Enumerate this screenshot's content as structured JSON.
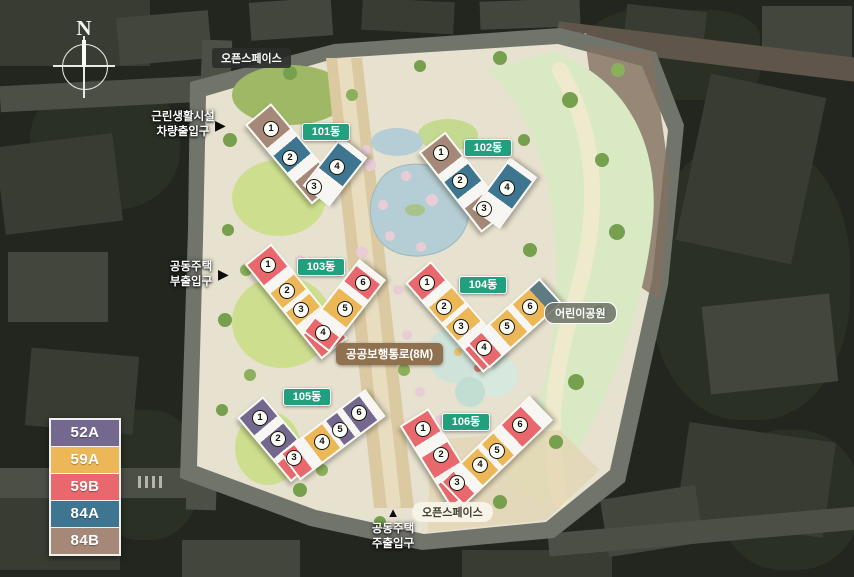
{
  "compass": {
    "label": "N"
  },
  "legend": [
    {
      "code": "52A",
      "color": "#75688f"
    },
    {
      "code": "59A",
      "color": "#ecb857"
    },
    {
      "code": "59B",
      "color": "#e8686d"
    },
    {
      "code": "84A",
      "color": "#3e7591"
    },
    {
      "code": "84B",
      "color": "#a58877"
    }
  ],
  "site_labels": {
    "open_space_top": "오픈스페이스",
    "open_space_bottom": "오픈스페이스",
    "children_park": "어린이공원",
    "public_walkway": "공공보행통로(8M)"
  },
  "entrances": [
    {
      "name": "근린생활시설 차량출입구",
      "line1": "근린생활시설",
      "line2": "차량출입구",
      "arrow": "▶"
    },
    {
      "name": "공동주택 부출입구",
      "line1": "공동주택",
      "line2": "부출입구",
      "arrow": "▶"
    },
    {
      "name": "공동주택 주출입구",
      "line1": "공동주택",
      "line2": "주출입구",
      "arrow": "▲"
    }
  ],
  "buildings": [
    {
      "name": "101동",
      "units": [
        {
          "no": "1",
          "type": "84B"
        },
        {
          "no": "2",
          "type": "84A"
        },
        {
          "no": "3",
          "type": "84B"
        },
        {
          "no": "4",
          "type": "84A"
        }
      ]
    },
    {
      "name": "102동",
      "units": [
        {
          "no": "1",
          "type": "84B"
        },
        {
          "no": "2",
          "type": "84A"
        },
        {
          "no": "3",
          "type": "84B"
        },
        {
          "no": "4",
          "type": "84A"
        }
      ]
    },
    {
      "name": "103동",
      "units": [
        {
          "no": "1",
          "type": "59B"
        },
        {
          "no": "2",
          "type": "59A"
        },
        {
          "no": "3",
          "type": "59A"
        },
        {
          "no": "4",
          "type": "59B"
        },
        {
          "no": "5",
          "type": "59A"
        },
        {
          "no": "6",
          "type": "59B"
        }
      ]
    },
    {
      "name": "104동",
      "units": [
        {
          "no": "1",
          "type": "59B"
        },
        {
          "no": "2",
          "type": "59A"
        },
        {
          "no": "3",
          "type": "59A"
        },
        {
          "no": "4",
          "type": "59B"
        },
        {
          "no": "5",
          "type": "59A"
        },
        {
          "no": "6",
          "type": "59A"
        }
      ]
    },
    {
      "name": "105동",
      "units": [
        {
          "no": "1",
          "type": "52A"
        },
        {
          "no": "2",
          "type": "52A"
        },
        {
          "no": "3",
          "type": "59B"
        },
        {
          "no": "4",
          "type": "59A"
        },
        {
          "no": "5",
          "type": "52A"
        },
        {
          "no": "6",
          "type": "52A"
        }
      ]
    },
    {
      "name": "106동",
      "units": [
        {
          "no": "1",
          "type": "59B"
        },
        {
          "no": "2",
          "type": "59B"
        },
        {
          "no": "3",
          "type": "59B"
        },
        {
          "no": "4",
          "type": "59A"
        },
        {
          "no": "5",
          "type": "59A"
        },
        {
          "no": "6",
          "type": "59B"
        }
      ]
    }
  ],
  "colors": {
    "building_badge": "#22a07e",
    "walkway_badge": "#8f7150",
    "site_base": "#e7e1cf",
    "park_strip": "#d9e9c4",
    "lawn": "#cddf8f",
    "pond": "#b5cdd4",
    "main_road": "#dbc9a2"
  }
}
